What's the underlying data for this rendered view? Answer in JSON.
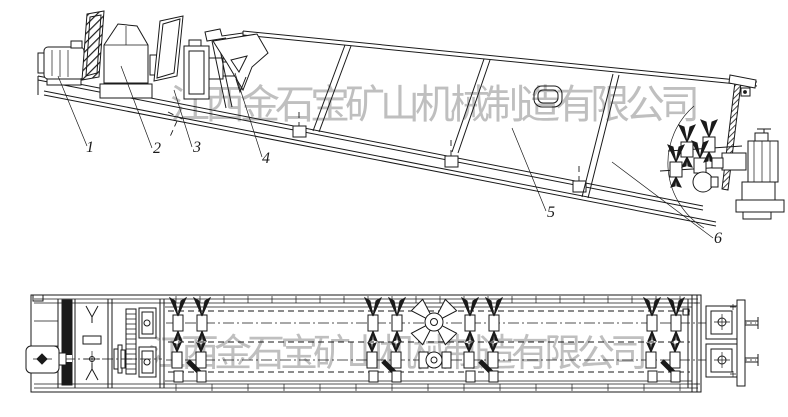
{
  "drawing": {
    "watermark_top": "江西金石宝矿山机械制造有限公司",
    "watermark_bottom": "江西金石宝矿山机械制造有限公司",
    "part_labels": {
      "p1": "1",
      "p2": "2",
      "p3": "3",
      "p4": "4",
      "p5": "5",
      "p6": "6"
    },
    "colors": {
      "line": "#1a1a1a",
      "watermark": "#b4b4b4",
      "background": "#ffffff"
    }
  }
}
